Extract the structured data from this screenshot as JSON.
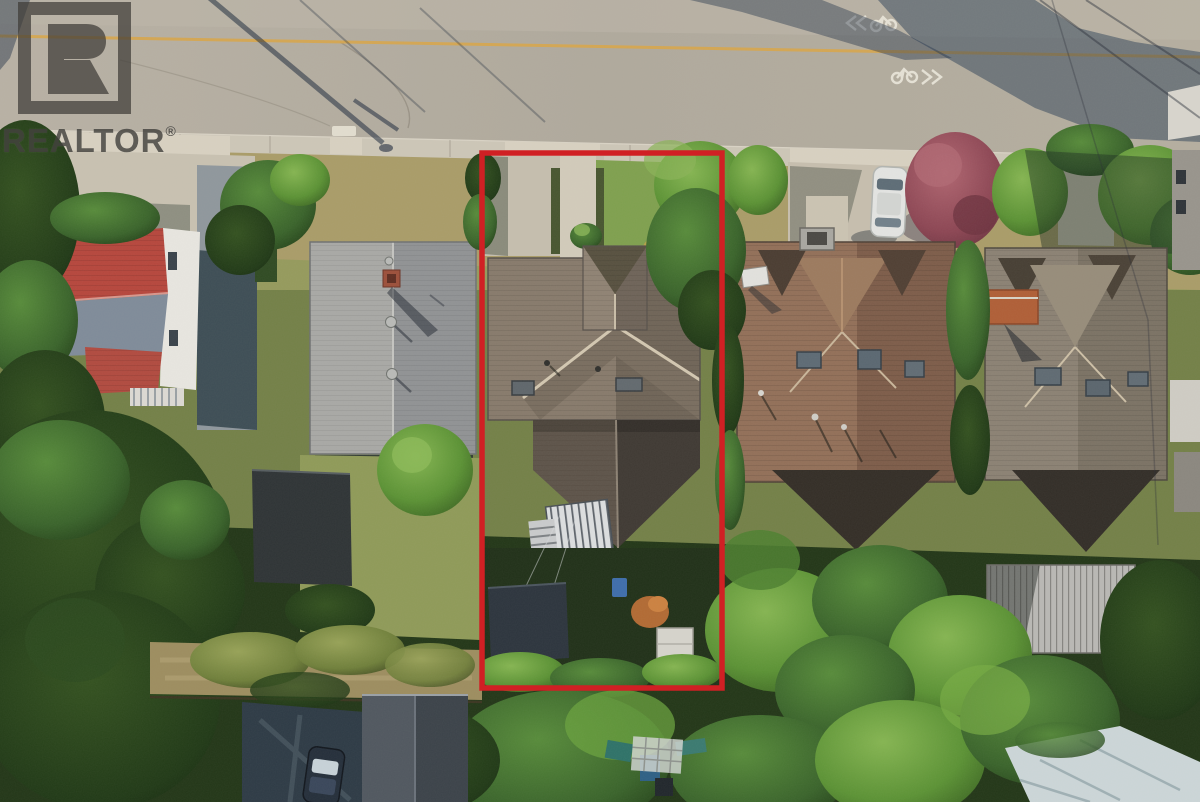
{
  "watermark": {
    "brand": "REALTOR",
    "registered": "®",
    "logo_letter": "R",
    "color": "#3e3c38"
  },
  "boundary": {
    "color": "#d02024",
    "stroke_width": 5.5
  },
  "road": {
    "center_line_color": "#d8a64b",
    "marking_color": "#eae6da",
    "sharrow_directions": [
      "westbound",
      "eastbound"
    ]
  },
  "icons": {
    "realtor_logo": "framed-R-block",
    "bike_sharrow": "bicycle-with-double-chevron"
  },
  "palette": {
    "road": "#b3ac9f",
    "sidewalk": "#cdc6b7",
    "dry_grass": "#a99c68",
    "red_roof": "#b6463c",
    "gray_roof": "#9e9f9d",
    "subject_roof": "#877a6b",
    "brown_roof": "#8a6752",
    "taupe_roof": "#8b8173",
    "forest_dark": "#1b2a14",
    "forest_bright": "#6aa23e"
  }
}
